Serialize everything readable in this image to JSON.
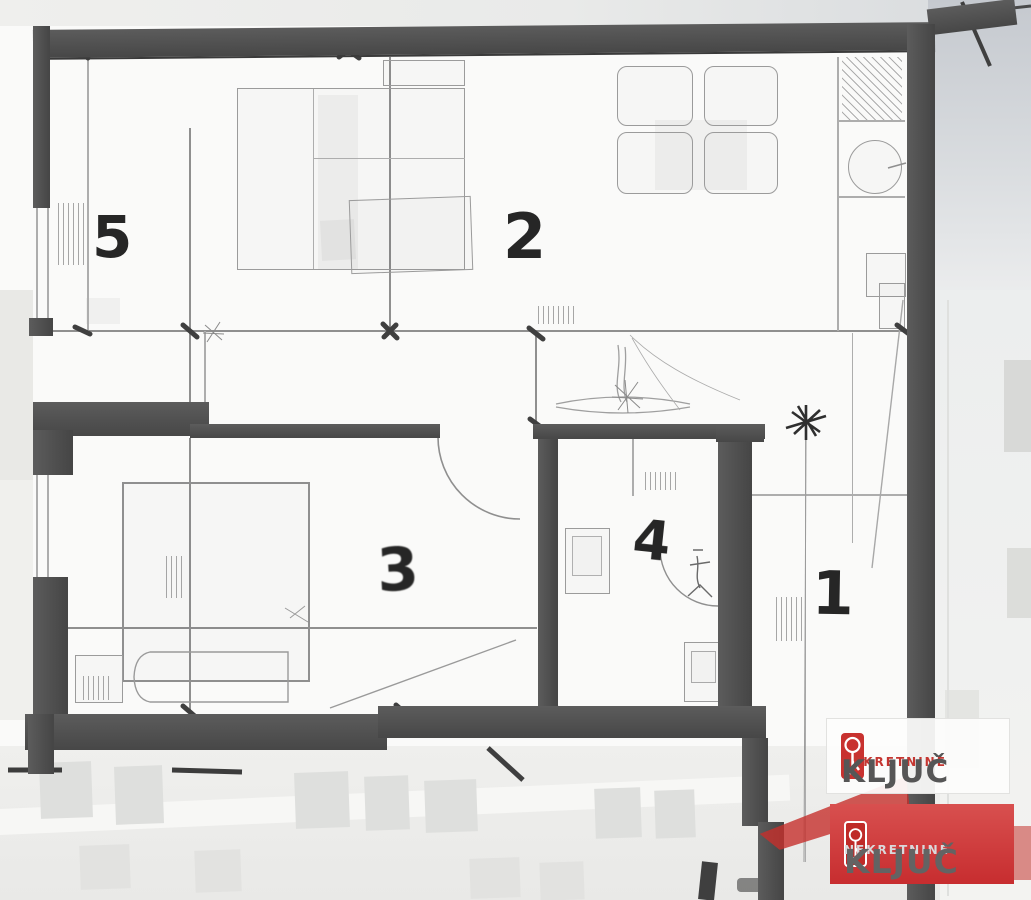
{
  "title": "apartment-floor-plan",
  "rooms": [
    {
      "number": "5"
    },
    {
      "number": "2"
    },
    {
      "number": "3"
    },
    {
      "number": "4"
    },
    {
      "number": "1"
    }
  ],
  "watermarks": {
    "primary": {
      "brand": "NEKRETNINE",
      "name": "KLJUČ"
    },
    "secondary": {
      "brand": "NEKRETNINE",
      "name": "KLJUČ"
    }
  },
  "colors": {
    "wall": "#4e4e4e",
    "pencil": "#8f8f8f",
    "logo_red": "#c8322f",
    "brand_red_text": "#c53631",
    "brand_dark_text": "#565656"
  }
}
